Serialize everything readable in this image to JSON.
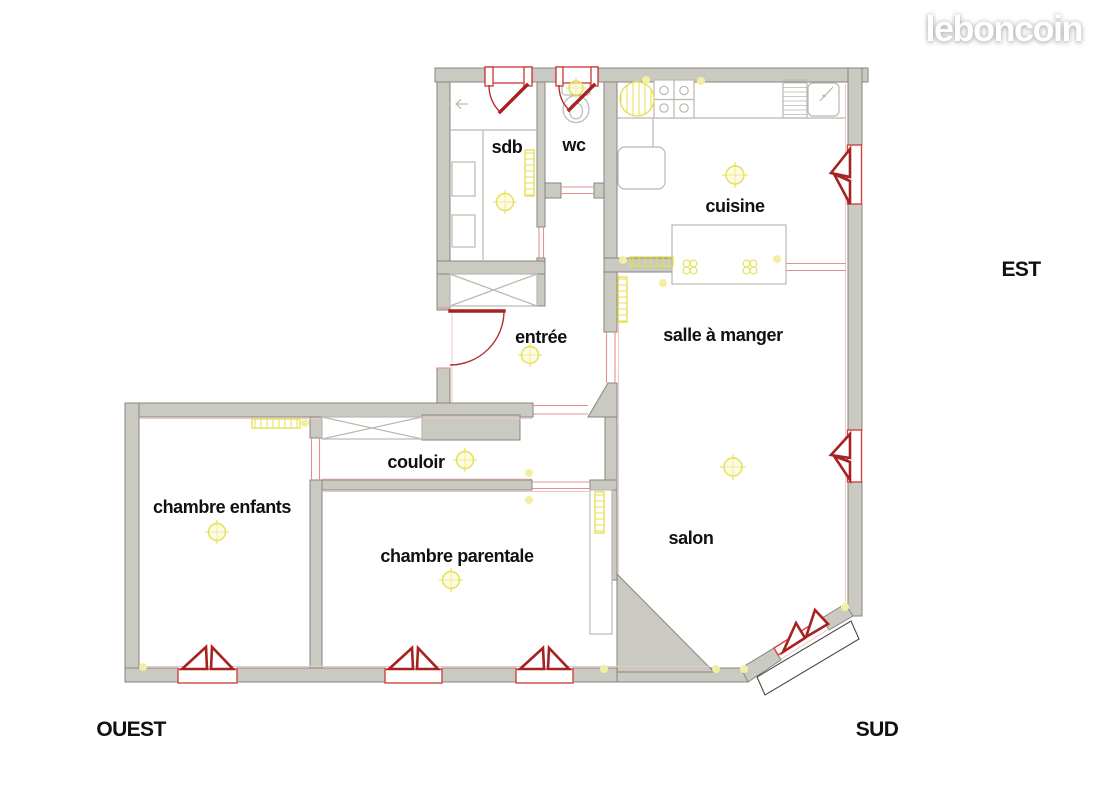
{
  "logo": {
    "text": "leboncoin"
  },
  "compass": {
    "est": "EST",
    "ouest": "OUEST",
    "sud": "SUD"
  },
  "rooms": {
    "sdb": {
      "label": "sdb"
    },
    "wc": {
      "label": "wc"
    },
    "cuisine": {
      "label": "cuisine"
    },
    "entree": {
      "label": "entrée"
    },
    "salle_a_manger": {
      "label": "salle à manger"
    },
    "couloir": {
      "label": "couloir"
    },
    "chambre_enfants": {
      "label": "chambre enfants"
    },
    "chambre_parentale": {
      "label": "chambre parentale"
    },
    "salon": {
      "label": "salon"
    }
  },
  "colors": {
    "wall_fill": "#cbcac2",
    "wall_stroke": "#85847d",
    "fixture_gray": "#b9b8b1",
    "window_red": "#a82121",
    "window_frame_red": "#cf4343",
    "door_arc_red": "#b43030",
    "opening_red": "#e39090",
    "hairline_red": "#f2c4c4",
    "yellow_stroke": "#e5df4e",
    "yellow_fill": "#faf7cf",
    "yellow_dot": "#f3efa2",
    "text_color": "#111111",
    "logo_color": "#ffffff"
  }
}
